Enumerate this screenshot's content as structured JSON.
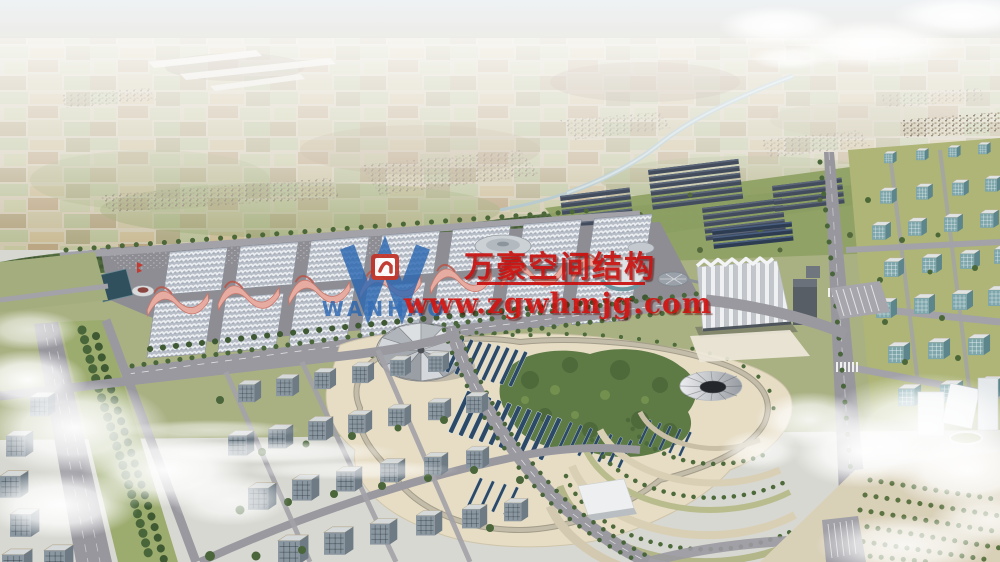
{
  "watermark": {
    "logo_letter": "W",
    "logo_wordmark": "WANHAO",
    "company_name": "万豪空间结构",
    "website": "www.zgwhmjg.com",
    "text_color": "#c9100e",
    "logo_color": "#2a66b2",
    "emblem_color": "#c23227"
  },
  "scene": {
    "palette": {
      "sky_haze": "#eef1f3",
      "farmland": "#d2c9b4",
      "tree_green": "#4e6b3c",
      "lawn": "#a9b183",
      "plaza_beige": "#e7ddc5",
      "road_gray": "#98979e",
      "hall_roof": "#b7bdc7",
      "canopy_pink": "#e7aca1",
      "solar_panel_blue": "#2c4a68",
      "river": "#a4bcc2",
      "cloud": "#ffffff"
    }
  }
}
